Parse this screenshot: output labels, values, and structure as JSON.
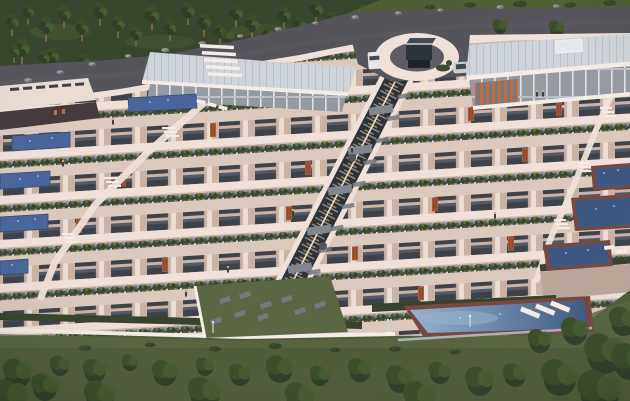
{
  "scene": {
    "title": "Terraced residential complex — aerial dusk render",
    "description": "Aerial 3D rendering at dusk of a stepped hillside apartment complex: pine forest and curved asphalt road at top, circular entry plaza with glass pavilion, a long central escalator-stair spine descending through planted roof terraces, lap pools on left terraces, square spa pools on right terraces, a long infinity pool with white steps at the garden level, hedges, lawns and a row of round trees at the bottom.",
    "terrace_count": 7,
    "left_lap_pools": 5,
    "right_spa_pools": 3,
    "main_pool": 1
  },
  "palette": {
    "forest": "#2c3d22",
    "forestLight": "#46572c",
    "grass": "#47552f",
    "grassLight": "#51603a",
    "road": "#4c4c54",
    "roadLight": "#5a5a62",
    "pavement": "#56545b",
    "parapet": "#eee0d9",
    "parapetShadow": "#c9b2a6",
    "white": "#f4ece6",
    "planter": "#343f2b",
    "floor": "#d9c7bb",
    "wall": "#c7b0a2",
    "window": "#323842",
    "windowLight": "#49525e",
    "column": "#e9dcd4",
    "roof": "#ccd3d9",
    "roofRib": "#b6bec6",
    "skylight": "#e2e9ef",
    "glass": "#8e959f",
    "mullion": "#e6dfd9",
    "glassBand": "#b9bfc7",
    "louver": "#bf6434",
    "door": "#a8542e",
    "doorDark": "#7c3b1f",
    "poolLight": "#8fb0cc",
    "pool": "#3f5e97",
    "poolDark": "#33517c",
    "poolBorder": "#713f38",
    "stairsDark": "#23282e",
    "stairsAmber": "#c9913f",
    "stairsGray": "#8f959d",
    "landing": "#7b8089",
    "hedge": "#2c3a22",
    "stone": "#b5a396",
    "slab": "#6d727a",
    "treeDark": "#26351d",
    "tree": "#31451f",
    "treeLight": "#3e5526",
    "trunk": "#7a5b43",
    "rock": "#93939a",
    "rockDark": "#6e6e75",
    "car": "#e3e6ea",
    "car2": "#c9ced4",
    "carDark": "#3a3f46",
    "skin": "#caa183",
    "figure": "#2e3540",
    "darkGlass": "#3b3134",
    "umbrella": "#4a4f56",
    "balustrade": "#b9c9d4",
    "lamp": "#cfd4d8"
  },
  "scatter": {
    "pines": [
      [
        12,
        20,
        1
      ],
      [
        28,
        10,
        0.9
      ],
      [
        46,
        24,
        1.1
      ],
      [
        64,
        12,
        1
      ],
      [
        82,
        26,
        0.95
      ],
      [
        100,
        9,
        1.05
      ],
      [
        118,
        22,
        1
      ],
      [
        136,
        32,
        0.9
      ],
      [
        152,
        13,
        1.1
      ],
      [
        170,
        26,
        0.95
      ],
      [
        188,
        9,
        1
      ],
      [
        204,
        20,
        1.05
      ],
      [
        220,
        30,
        0.9
      ],
      [
        236,
        11,
        1
      ],
      [
        252,
        22,
        1.1
      ],
      [
        268,
        32,
        0.85
      ],
      [
        284,
        13,
        1
      ],
      [
        300,
        23,
        0.95
      ],
      [
        316,
        7,
        1.05
      ],
      [
        332,
        17,
        0.9
      ],
      [
        348,
        26,
        0.8
      ],
      [
        362,
        10,
        0.85
      ],
      [
        22,
        46,
        1.15
      ],
      [
        52,
        54,
        1.05
      ],
      [
        84,
        60,
        1.0
      ],
      [
        114,
        64,
        0.9
      ],
      [
        14,
        50,
        0.8
      ],
      [
        44,
        56,
        0.85
      ]
    ],
    "topBushes": [
      [
        470,
        5,
        1
      ],
      [
        520,
        4,
        1.2
      ],
      [
        570,
        5,
        1
      ],
      [
        610,
        3,
        1.1
      ],
      [
        430,
        7,
        0.9
      ]
    ],
    "roadRocks": [
      [
        92,
        64,
        1
      ],
      [
        128,
        56,
        0.9
      ],
      [
        165,
        50,
        1.1
      ],
      [
        202,
        43,
        1
      ],
      [
        240,
        36,
        0.9
      ],
      [
        278,
        29,
        1
      ],
      [
        315,
        23,
        0.8
      ],
      [
        355,
        17,
        1
      ],
      [
        398,
        13,
        0.9
      ],
      [
        440,
        10,
        0.8
      ],
      [
        60,
        72,
        1
      ],
      [
        28,
        80,
        1.1
      ],
      [
        12,
        96,
        1
      ],
      [
        42,
        92,
        0.9
      ],
      [
        500,
        7,
        1
      ],
      [
        556,
        6,
        0.9
      ]
    ],
    "roadTrees": [
      [
        500,
        26,
        1
      ],
      [
        557,
        28,
        1.1
      ],
      [
        228,
        36,
        0.9
      ]
    ],
    "doors": [
      [
        210,
        136
      ],
      [
        468,
        136
      ],
      [
        556,
        136
      ],
      [
        120,
        180
      ],
      [
        305,
        180
      ],
      [
        522,
        180
      ],
      [
        76,
        224
      ],
      [
        286,
        224
      ],
      [
        432,
        224
      ],
      [
        162,
        268
      ],
      [
        352,
        268
      ],
      [
        508,
        268
      ],
      [
        232,
        312
      ],
      [
        418,
        312
      ]
    ],
    "people": [
      [
        113,
        124
      ],
      [
        63,
        166
      ],
      [
        537,
        96
      ],
      [
        543,
        96
      ],
      [
        465,
        139
      ],
      [
        293,
        215
      ],
      [
        495,
        218
      ],
      [
        352,
        152
      ],
      [
        228,
        272
      ],
      [
        186,
        296
      ]
    ],
    "slabs": [
      [
        404,
        96
      ],
      [
        393,
        118
      ],
      [
        382,
        140
      ],
      [
        370,
        162
      ],
      [
        359,
        184
      ],
      [
        348,
        206
      ],
      [
        337,
        228
      ],
      [
        325,
        250
      ],
      [
        314,
        272
      ],
      [
        303,
        294
      ]
    ],
    "pavers": [
      [
        225,
        300
      ],
      [
        245,
        295
      ],
      [
        266,
        305
      ],
      [
        287,
        299
      ],
      [
        240,
        314
      ],
      [
        263,
        317
      ],
      [
        300,
        311
      ],
      [
        216,
        321
      ],
      [
        320,
        305
      ]
    ],
    "bottomTrees": [
      [
        18,
        372,
        1.6
      ],
      [
        60,
        365,
        1.1
      ],
      [
        95,
        370,
        1.3
      ],
      [
        130,
        362,
        0.9
      ],
      [
        165,
        372,
        1.4
      ],
      [
        205,
        366,
        1.0
      ],
      [
        240,
        374,
        1.2
      ],
      [
        280,
        368,
        1.5
      ],
      [
        320,
        375,
        1.1
      ],
      [
        360,
        369,
        1.3
      ],
      [
        400,
        378,
        1.5
      ],
      [
        440,
        372,
        1.2
      ],
      [
        480,
        380,
        1.6
      ],
      [
        515,
        374,
        1.3
      ],
      [
        205,
        392,
        1.8
      ],
      [
        300,
        396,
        1.6
      ],
      [
        420,
        396,
        1.8
      ],
      [
        100,
        395,
        1.7
      ],
      [
        540,
        340,
        1.3
      ],
      [
        575,
        330,
        1.5
      ],
      [
        605,
        352,
        2.2
      ],
      [
        560,
        376,
        2.0
      ],
      [
        600,
        390,
        2.4
      ],
      [
        624,
        320,
        1.6
      ],
      [
        10,
        396,
        2.0
      ],
      [
        45,
        386,
        1.5
      ],
      [
        630,
        360,
        2.0
      ]
    ],
    "lawnBushes": [
      [
        85,
        348,
        1
      ],
      [
        150,
        345,
        0.9
      ],
      [
        215,
        349,
        1
      ],
      [
        275,
        346,
        1.1
      ],
      [
        335,
        350,
        0.9
      ],
      [
        395,
        349,
        1
      ],
      [
        455,
        352,
        0.9
      ]
    ],
    "lamps": [
      [
        213,
        333
      ],
      [
        388,
        331
      ],
      [
        470,
        327
      ]
    ],
    "sparkles": [
      [
        30,
        141
      ],
      [
        52,
        138
      ],
      [
        20,
        179
      ],
      [
        38,
        176
      ],
      [
        18,
        221
      ],
      [
        35,
        219
      ],
      [
        12,
        265
      ],
      [
        150,
        102
      ],
      [
        168,
        100
      ],
      [
        604,
        173
      ],
      [
        618,
        170
      ],
      [
        596,
        209
      ],
      [
        614,
        206
      ],
      [
        566,
        253
      ],
      [
        588,
        250
      ],
      [
        460,
        318
      ],
      [
        500,
        314
      ],
      [
        530,
        310
      ]
    ]
  }
}
